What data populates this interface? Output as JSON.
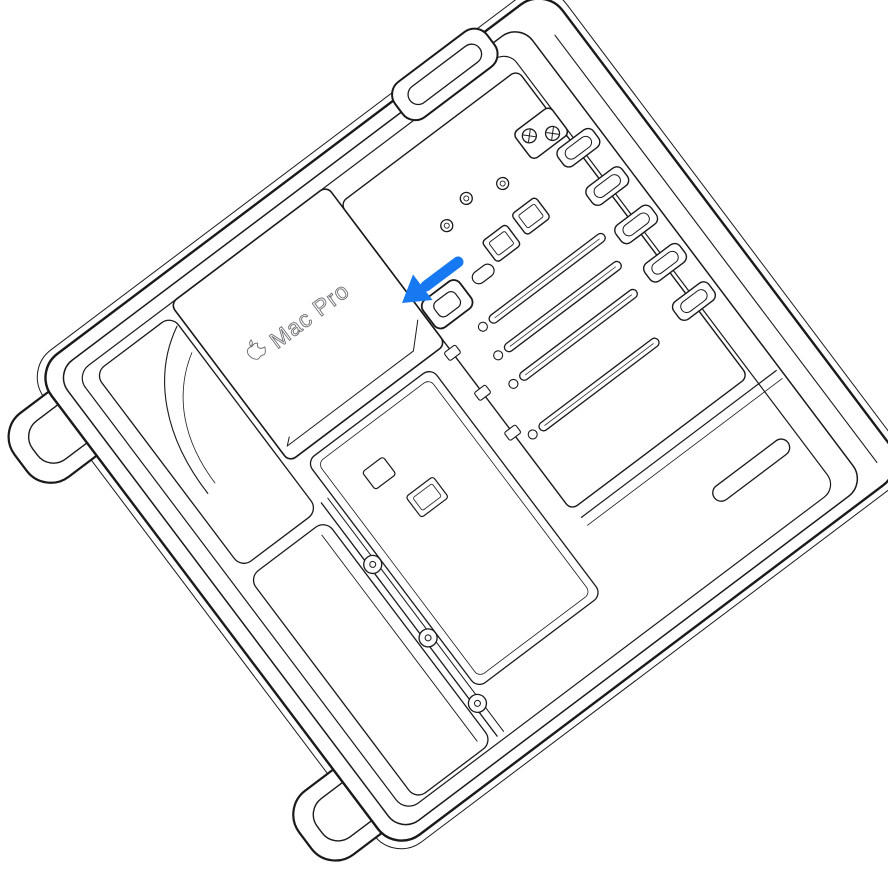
{
  "illustration": {
    "background_color": "#FFFFFF",
    "line_color": "#1A1A1A",
    "device_label": {
      "logo": "apple-logo",
      "text": "Mac Pro",
      "color": "#6E6E73"
    },
    "arrow": {
      "color": "#1679F2",
      "direction": "down-left"
    },
    "parts_depicted": [
      "open case frame",
      "foot handles",
      "top handle",
      "power supply cover",
      "logic board",
      "pcie slots",
      "pcie slot covers",
      "latch"
    ]
  }
}
